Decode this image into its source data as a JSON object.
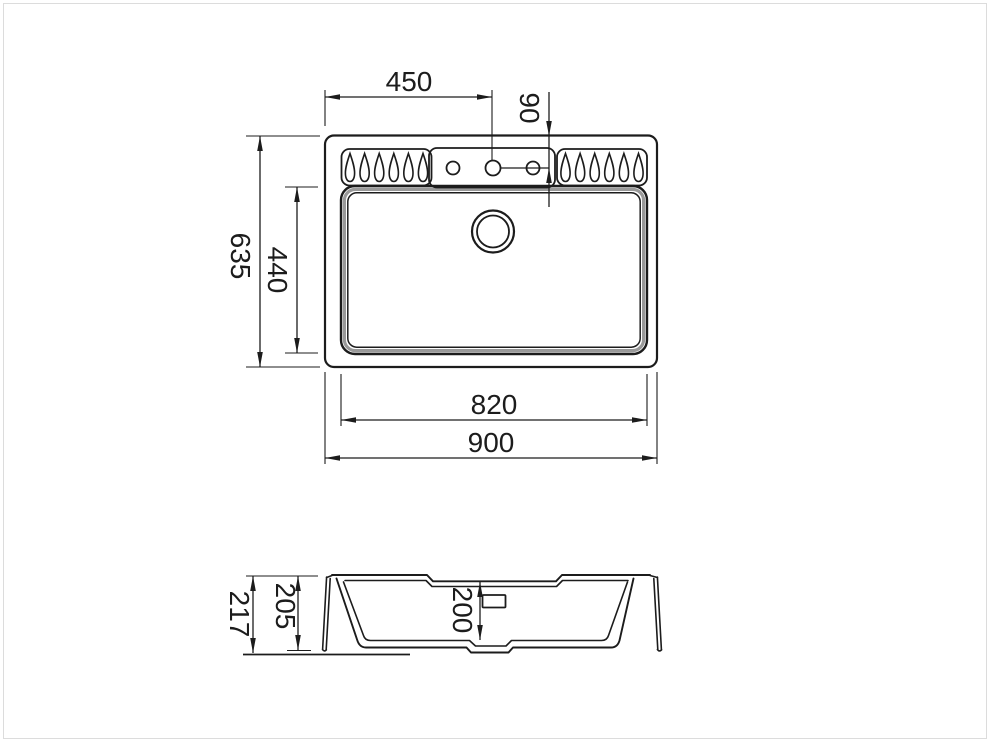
{
  "colors": {
    "line": "#1c1c1c",
    "frame": "#dcdcdc",
    "accent_gray": "#999999"
  },
  "top_view": {
    "dim_450": "450",
    "dim_90": "90",
    "dim_635": "635",
    "dim_440": "440",
    "dim_820": "820",
    "dim_900": "900",
    "tap_holes_count": 3,
    "drainer_grooves_per_side": 6
  },
  "section_view": {
    "dim_217": "217",
    "dim_205": "205",
    "dim_200": "200"
  }
}
